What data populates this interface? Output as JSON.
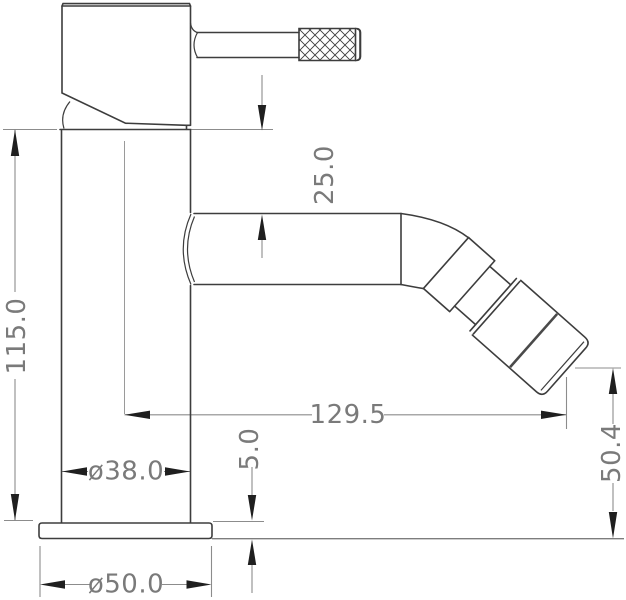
{
  "drawing": {
    "kind": "technical dimension drawing",
    "subject": "single-lever bidet mixer tap, side elevation",
    "units_implied": "mm"
  },
  "colors": {
    "background": "#ffffff",
    "outline": "#3d3d3d",
    "dimension_lines": "#8c8c8c",
    "arrowheads": "#1f1f1f",
    "dimension_text": "#7a7a7a"
  },
  "dims": {
    "spout_top_offset": {
      "label": "25.0"
    },
    "body_height": {
      "label": "115.0"
    },
    "spout_reach": {
      "label": "129.5"
    },
    "body_diameter": {
      "label": "ø38.0"
    },
    "base_plate_height": {
      "label": "5.0"
    },
    "outlet_height": {
      "label": "50.4"
    },
    "base_diameter": {
      "label": "ø50.0"
    }
  }
}
